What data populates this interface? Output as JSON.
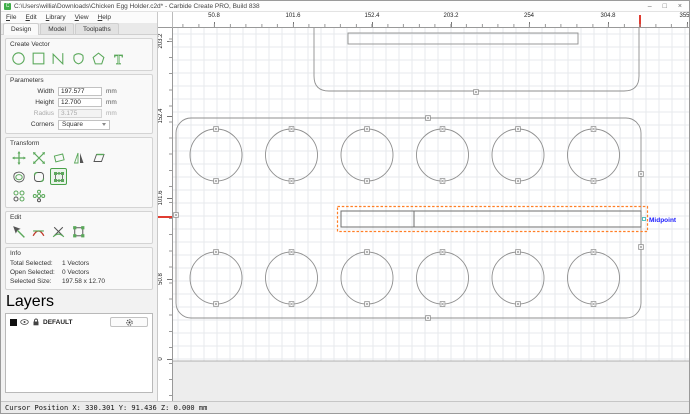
{
  "window": {
    "title": "C:\\Users\\willia\\Downloads\\Chicken Egg Holder.c2d* - Carbide Create PRO, Build 838",
    "controls": {
      "minimize": "–",
      "maximize": "□",
      "close": "×"
    }
  },
  "menu": {
    "items": [
      "File",
      "Edit",
      "Library",
      "View",
      "Help"
    ]
  },
  "tabs": {
    "items": [
      "Design",
      "Model",
      "Toolpaths"
    ],
    "active": "Design"
  },
  "create_vector": {
    "label": "Create Vector",
    "tools": [
      "circle",
      "rectangle",
      "polyline",
      "curve",
      "polygon",
      "text"
    ]
  },
  "parameters": {
    "label": "Parameters",
    "width_label": "Width",
    "width_value": "197.577",
    "height_label": "Height",
    "height_value": "12.700",
    "radius_label": "Radius",
    "radius_value": "3.175",
    "corners_label": "Corners",
    "corners_value": "Square",
    "unit": "mm"
  },
  "transform": {
    "label": "Transform",
    "tools": [
      "move",
      "scale",
      "rotate",
      "mirror",
      "skew",
      "offset",
      "fillet",
      "edit-handles",
      "linear-array",
      "circular-array"
    ],
    "active_tool": "edit-handles"
  },
  "edit": {
    "label": "Edit",
    "tools": [
      "node-edit",
      "trim",
      "split",
      "join"
    ]
  },
  "info": {
    "label": "Info",
    "total_label": "Total Selected:",
    "total_value": "1 Vectors",
    "open_label": "Open Selected:",
    "open_value": "0 Vectors",
    "size_label": "Selected Size:",
    "size_value": "197.58 x 12.70"
  },
  "layers": {
    "label": "Layers",
    "layer_name": "DEFAULT"
  },
  "ruler": {
    "h_labels": [
      {
        "pos": 41,
        "text": "50.8"
      },
      {
        "pos": 120,
        "text": "101.6"
      },
      {
        "pos": 199,
        "text": "152.4"
      },
      {
        "pos": 278,
        "text": "203.2"
      },
      {
        "pos": 356,
        "text": "254"
      },
      {
        "pos": 435,
        "text": "304.8"
      },
      {
        "pos": 514,
        "text": "355.6"
      }
    ],
    "v_labels": [
      {
        "pos": 13,
        "text": "203.2"
      },
      {
        "pos": 88,
        "text": "152.4"
      },
      {
        "pos": 170,
        "text": "101.6"
      },
      {
        "pos": 251,
        "text": "50.8"
      },
      {
        "pos": 331,
        "text": "0"
      }
    ],
    "cursor_x": 466,
    "cursor_y": 188
  },
  "colors": {
    "accent_green": "#3fae49",
    "icon_green": "#5aa85a",
    "icon_dark": "#555555",
    "vector_gray": "#8f8f8f",
    "slot_gray": "#6f6f6f",
    "selection_orange": "#ff7f27",
    "midpoint_blue": "#1a1aff",
    "cursor_red": "#e03c31",
    "grid": "#e7eaec",
    "offstock": "#ededed"
  },
  "canvas": {
    "width": 518,
    "height": 373,
    "grid_size": 13,
    "stock_bottom_y": 333,
    "top_shape": {
      "path": "M141,-2 V48 Q141,63 156,63 H451 Q466,63 466,48 V-2",
      "inner_rect": {
        "x": 175,
        "y": 5,
        "w": 230,
        "h": 11
      },
      "marker": [
        303,
        64
      ]
    },
    "main_rect": {
      "x": 3,
      "y": 90,
      "w": 465,
      "h": 200,
      "r": 15,
      "markers": [
        [
          255,
          90
        ],
        [
          255,
          290
        ],
        [
          3,
          187
        ],
        [
          468,
          146
        ],
        [
          468,
          219
        ]
      ]
    },
    "circles": {
      "r": 26,
      "row_y": [
        127,
        250
      ],
      "col_x": [
        43,
        118.5,
        194,
        269.5,
        345,
        420.5
      ]
    },
    "slot": {
      "rect": {
        "x": 168,
        "y": 183,
        "w": 300,
        "h": 16
      },
      "divider_x": 241,
      "selection": {
        "x": 164.5,
        "y": 178.5,
        "w": 310,
        "h": 25
      }
    },
    "midpoint": {
      "label": "Midpoint",
      "text_x": 476,
      "text_y": 194,
      "marker": [
        471,
        191
      ]
    }
  },
  "statusbar": {
    "text": "Cursor Position X: 330.301 Y: 91.436 Z: 0.000 mm"
  }
}
